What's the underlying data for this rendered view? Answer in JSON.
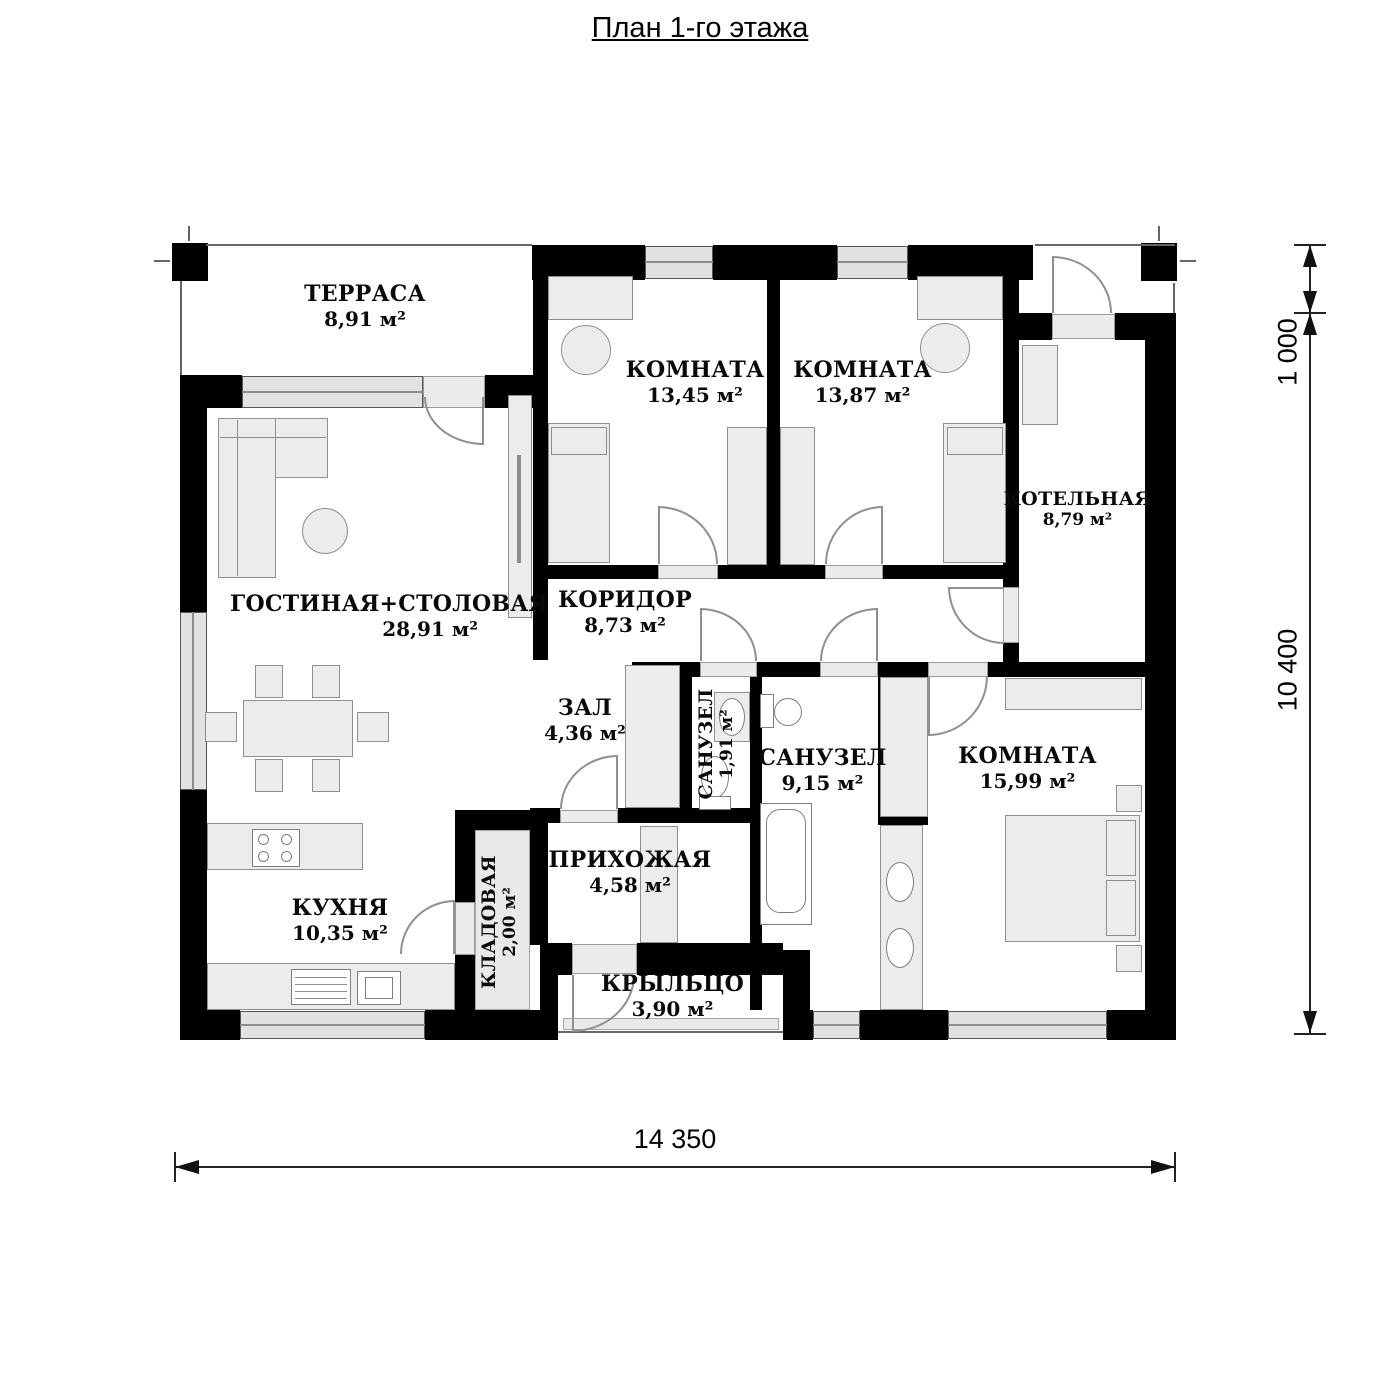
{
  "title": "План 1-го этажа",
  "rooms": [
    {
      "id": "terrace",
      "name": "ТЕРРАСА",
      "area": "8,91 м²"
    },
    {
      "id": "bedroom-1",
      "name": "КОМНАТА",
      "area": "13,45 м²"
    },
    {
      "id": "bedroom-2",
      "name": "КОМНАТА",
      "area": "13,87 м²"
    },
    {
      "id": "boiler-room",
      "name": "КОТЕЛЬНАЯ",
      "area": "8,79 м²"
    },
    {
      "id": "living-dining",
      "name": "ГОСТИНАЯ+СТОЛОВАЯ",
      "area": "28,91 м²"
    },
    {
      "id": "corridor",
      "name": "КОРИДОР",
      "area": "8,73 м²"
    },
    {
      "id": "hall",
      "name": "ЗАЛ",
      "area": "4,36 м²"
    },
    {
      "id": "wc-small",
      "name": "САНУЗЕЛ",
      "area": "1,91 м²"
    },
    {
      "id": "bathroom",
      "name": "САНУЗЕЛ",
      "area": "9,15 м²"
    },
    {
      "id": "bedroom-3",
      "name": "КОМНАТА",
      "area": "15,99 м²"
    },
    {
      "id": "entry-hall",
      "name": "ПРИХОЖАЯ",
      "area": "4,58 м²"
    },
    {
      "id": "kitchen",
      "name": "КУХНЯ",
      "area": "10,35 м²"
    },
    {
      "id": "pantry",
      "name": "КЛАДОВАЯ",
      "area": "2,00 м²"
    },
    {
      "id": "porch",
      "name": "КРЫЛЬЦО",
      "area": "3,90 м²"
    }
  ],
  "dimensions": {
    "overall_width": "14 350",
    "main_depth": "10 400",
    "terrace_offset": "1 000"
  },
  "colors": {
    "wall": "#000000",
    "window_fill": "#e2e2e2",
    "furniture_fill": "#ececec",
    "furniture_stroke": "#8f8f8f",
    "door_arc": "#909090"
  }
}
